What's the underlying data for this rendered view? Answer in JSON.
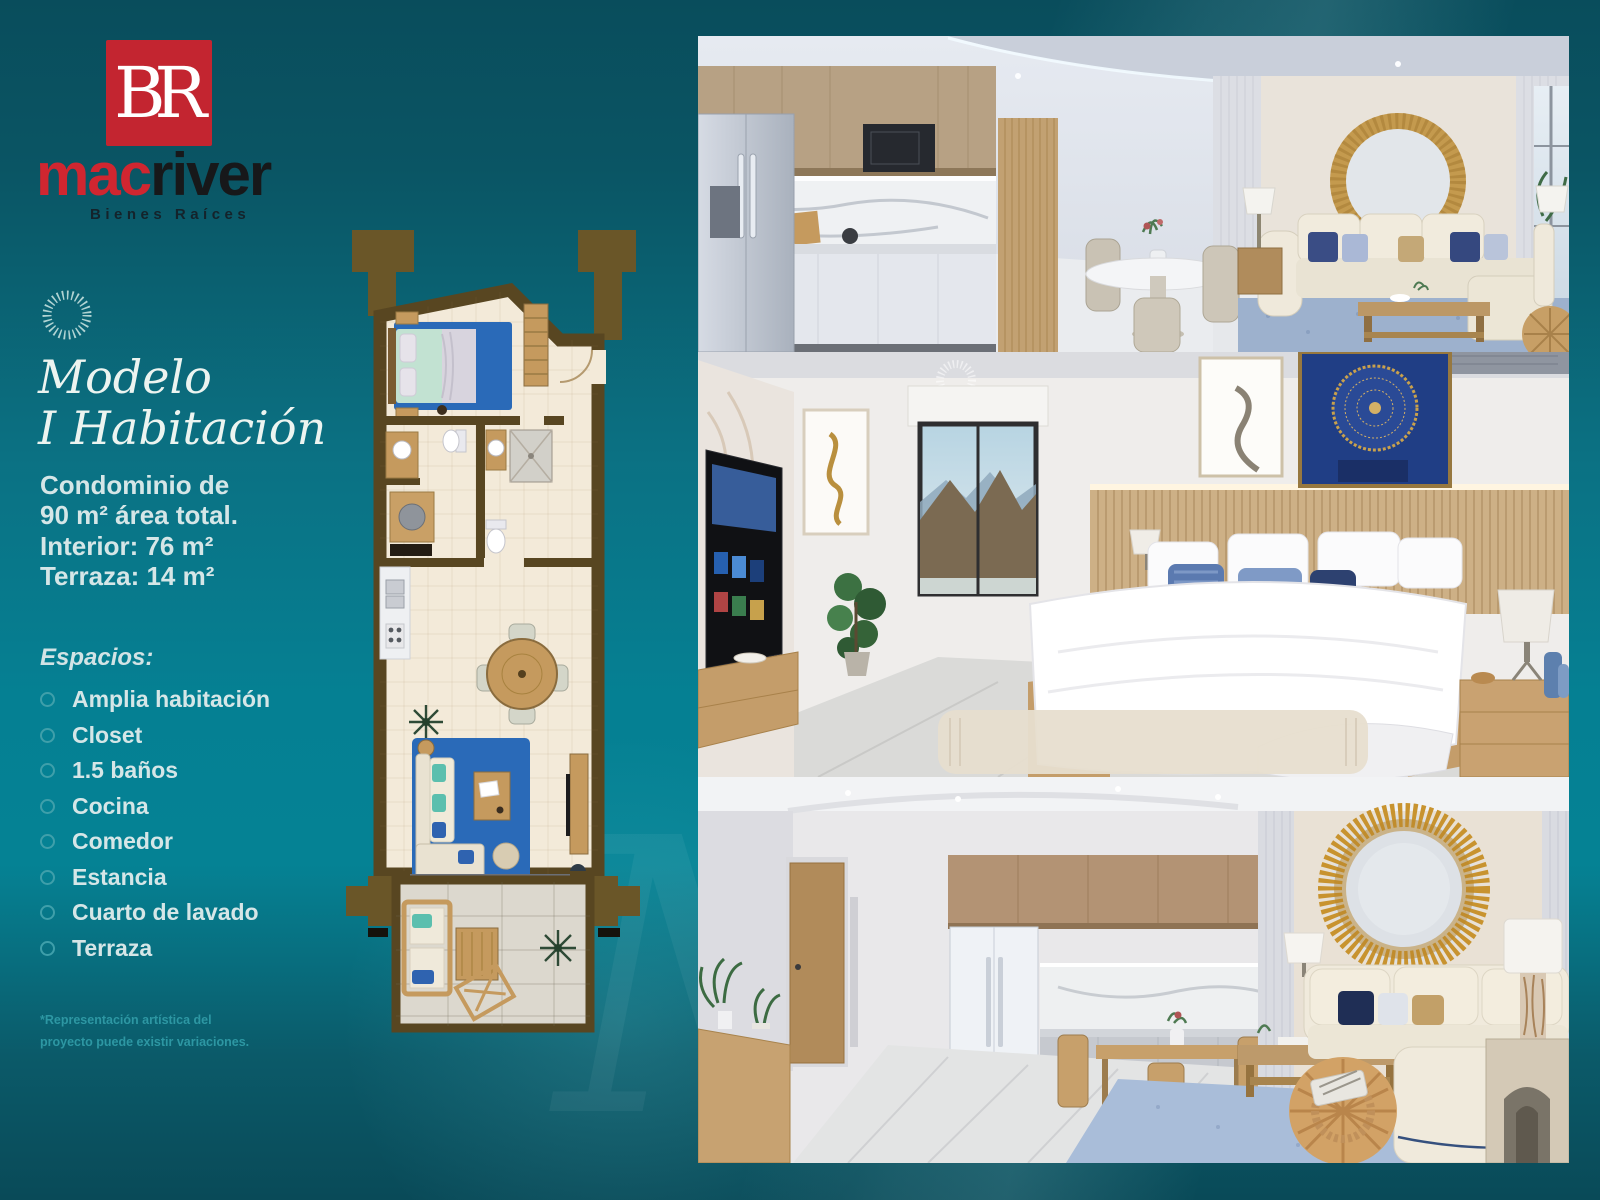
{
  "brand": {
    "monogram": "BR",
    "name_part1": "mac",
    "name_part2": "river",
    "tagline": "Bienes Raíces"
  },
  "model": {
    "title_line1": "Modelo",
    "title_line2": "I Habitación"
  },
  "specs": {
    "lines": [
      "Condominio de",
      "90 m² área total.",
      "Interior: 76 m²",
      "Terraza: 14 m²"
    ]
  },
  "spaces": {
    "heading": "Espacios:",
    "items": [
      "Amplia habitación",
      "Closet",
      "1.5 baños",
      "Cocina",
      "Comedor",
      "Estancia",
      "Cuarto de lavado",
      "Terraza"
    ]
  },
  "footnote": {
    "line1": "*Representación artística del",
    "line2": "proyecto puede existir variaciones."
  },
  "icons": {
    "sunburst_badge": "sunburst-icon",
    "photo_watermark": "sunburst-watermark-icon"
  },
  "colors": {
    "accent_red": "#c32530",
    "brand_dark": "#17181a",
    "background_teal_dark": "#094d5c",
    "background_teal_light": "#058093",
    "text_light": "#d5e6e7",
    "title_cream": "#ecf4f0",
    "footnote_teal": "#2d97a3",
    "floorplan_wall_brown": "#584621",
    "floorplan_pylon_brown": "#6a5628",
    "floorplan_floor_cream": "#f3ead9",
    "rug_blue": "#2a6ab8",
    "wood_tan": "#c59a5e"
  },
  "floorplan": {
    "name": "one-bedroom-unit-floor-plan"
  },
  "photos": [
    {
      "name": "render-kitchen-dining-living"
    },
    {
      "name": "render-bedroom-mountain-view"
    },
    {
      "name": "render-living-room-kitchen"
    }
  ]
}
